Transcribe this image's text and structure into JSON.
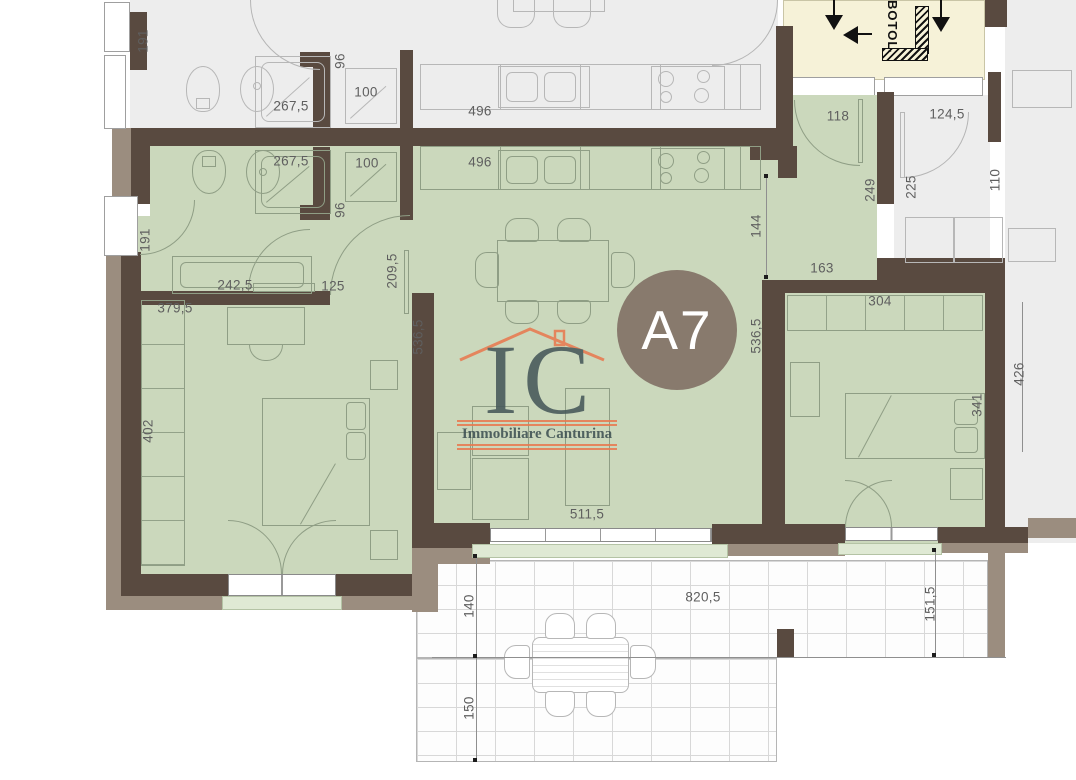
{
  "plan": {
    "unit_badge": "A7",
    "stairwell_label": "BOTOLA",
    "logo": {
      "monogram": "IC",
      "company": "Immobiliare Canturina"
    },
    "colors": {
      "apartment_fill": "#cbd8bc",
      "window_sill_fill": "#dfe9d4",
      "wall_dark": "#594a40",
      "wall_outer": "#9b8d7f",
      "stairwell_fill": "#f6f2d8",
      "neighbor_fill": "#ededed",
      "badge_fill": "#887a6d",
      "badge_text": "#ffffff",
      "logo_orange": "#e87a50",
      "logo_slate": "#46585a",
      "dimension_text": "#5f5f5f"
    },
    "dimensions": [
      {
        "text": "191",
        "x": 143,
        "y": 41,
        "vertical": true
      },
      {
        "text": "96",
        "x": 340,
        "y": 61,
        "vertical": true
      },
      {
        "text": "267,5",
        "x": 291,
        "y": 106,
        "vertical": false
      },
      {
        "text": "100",
        "x": 366,
        "y": 92,
        "vertical": false
      },
      {
        "text": "496",
        "x": 480,
        "y": 111,
        "vertical": false
      },
      {
        "text": "267,5",
        "x": 291,
        "y": 161,
        "vertical": false
      },
      {
        "text": "100",
        "x": 367,
        "y": 163,
        "vertical": false
      },
      {
        "text": "496",
        "x": 480,
        "y": 162,
        "vertical": false
      },
      {
        "text": "96",
        "x": 340,
        "y": 210,
        "vertical": true
      },
      {
        "text": "191",
        "x": 145,
        "y": 240,
        "vertical": true
      },
      {
        "text": "118",
        "x": 838,
        "y": 116,
        "vertical": false
      },
      {
        "text": "124,5",
        "x": 947,
        "y": 114,
        "vertical": false
      },
      {
        "text": "249",
        "x": 870,
        "y": 190,
        "vertical": true
      },
      {
        "text": "225",
        "x": 911,
        "y": 187,
        "vertical": true
      },
      {
        "text": "110",
        "x": 995,
        "y": 180,
        "vertical": true
      },
      {
        "text": "144",
        "x": 756,
        "y": 226,
        "vertical": true
      },
      {
        "text": "163",
        "x": 822,
        "y": 268,
        "vertical": false
      },
      {
        "text": "304",
        "x": 880,
        "y": 301,
        "vertical": false
      },
      {
        "text": "242,5",
        "x": 235,
        "y": 285,
        "vertical": false
      },
      {
        "text": "125",
        "x": 333,
        "y": 286,
        "vertical": false
      },
      {
        "text": "209,5",
        "x": 392,
        "y": 271,
        "vertical": true
      },
      {
        "text": "379,5",
        "x": 175,
        "y": 308,
        "vertical": false
      },
      {
        "text": "536,5",
        "x": 418,
        "y": 337,
        "vertical": true
      },
      {
        "text": "536,5",
        "x": 756,
        "y": 336,
        "vertical": true
      },
      {
        "text": "402",
        "x": 148,
        "y": 431,
        "vertical": true
      },
      {
        "text": "341",
        "x": 977,
        "y": 405,
        "vertical": true
      },
      {
        "text": "426",
        "x": 1019,
        "y": 374,
        "vertical": true
      },
      {
        "text": "511,5",
        "x": 587,
        "y": 514,
        "vertical": false
      },
      {
        "text": "820,5",
        "x": 703,
        "y": 597,
        "vertical": false
      },
      {
        "text": "140",
        "x": 469,
        "y": 606,
        "vertical": true
      },
      {
        "text": "150",
        "x": 469,
        "y": 708,
        "vertical": true
      },
      {
        "text": "151,5",
        "x": 930,
        "y": 604,
        "vertical": true
      }
    ]
  }
}
